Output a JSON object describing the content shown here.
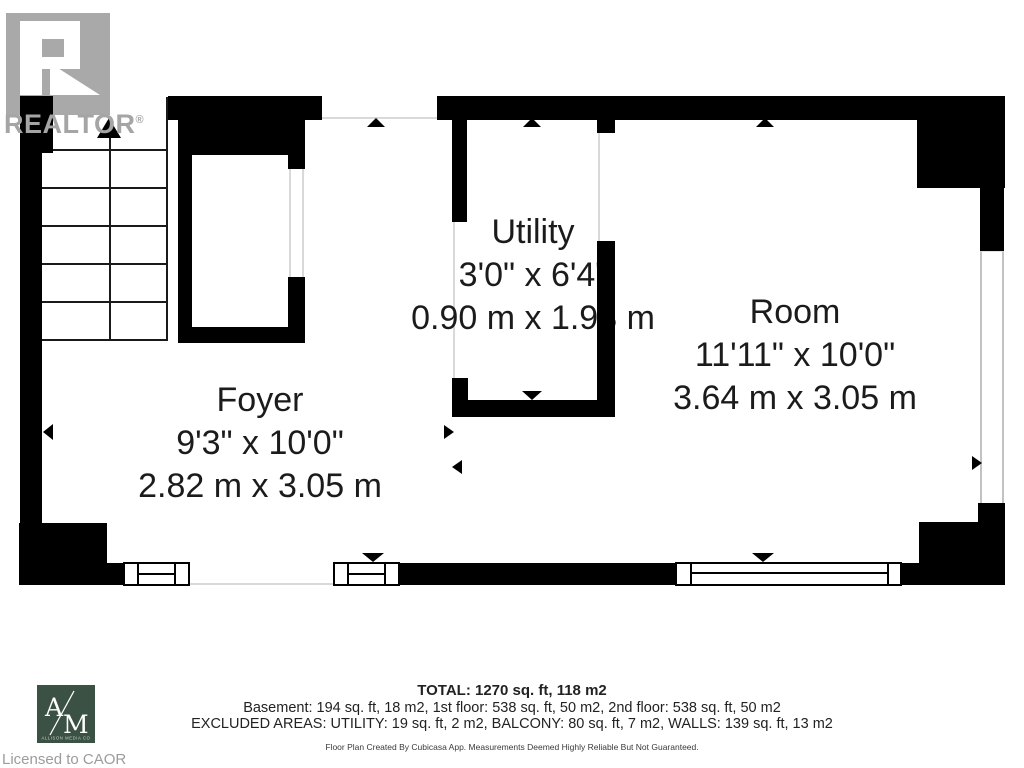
{
  "branding": {
    "realtor": {
      "logo_text": "REALTOR",
      "registered": "®"
    },
    "allison_media": {
      "letter_a": "A",
      "letter_m": "M",
      "subtext": "ALLISON MEDIA CO"
    },
    "license": "Licensed to CAOR"
  },
  "rooms": [
    {
      "name": "Foyer",
      "imperial": "9'3\" x 10'0\"",
      "metric": "2.82 m x 3.05 m"
    },
    {
      "name": "Utility",
      "imperial": "3'0\" x 6'4\"",
      "metric": "0.90 m x 1.93 m"
    },
    {
      "name": "Room",
      "imperial": "11'11\" x 10'0\"",
      "metric": "3.64 m x 3.05 m"
    }
  ],
  "summary": {
    "total": "TOTAL: 1270 sq. ft, 118 m2",
    "floors": "Basement: 194 sq. ft, 18 m2, 1st floor: 538 sq. ft, 50 m2, 2nd floor: 538 sq. ft, 50 m2",
    "excluded": "EXCLUDED AREAS: UTILITY: 19 sq. ft, 2 m2, BALCONY: 80 sq. ft, 7 m2, WALLS: 139 sq. ft, 13 m2",
    "disclaimer": "Floor Plan Created By Cubicasa App. Measurements Deemed Highly Reliable But Not Guaranteed."
  },
  "colors": {
    "wall": "#000000",
    "realtor_gray": "#a5a5a5",
    "agency_green": "#3b5143",
    "license_gray": "#9c9c9c"
  }
}
